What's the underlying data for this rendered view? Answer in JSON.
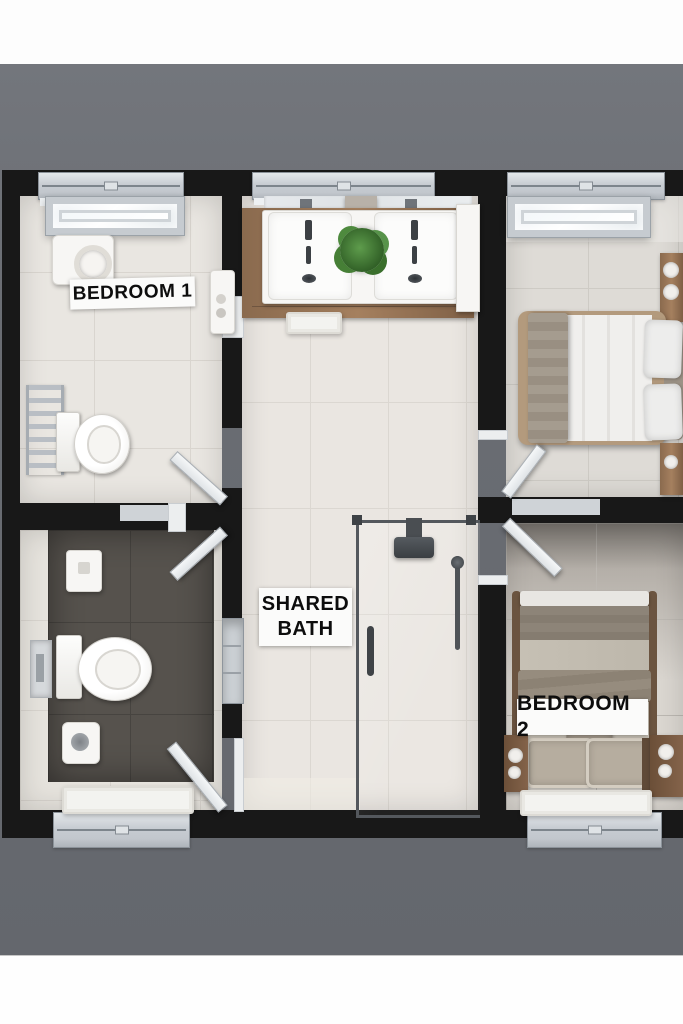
{
  "title": "3D floor plan render - two bedrooms with shared bath",
  "view": "top-down",
  "labels": {
    "bedroom1": "BEDROOM 1",
    "shared_bath": [
      "SHARED",
      "BATH"
    ],
    "bedroom2": "BEDROOM 2"
  },
  "rooms": [
    {
      "id": "bedroom-1",
      "label": "BEDROOM 1",
      "floor": "light ceramic tile",
      "fixtures": [
        "skylight-window",
        "towel-cabinet",
        "towel-radiator",
        "toilet",
        "wall-shelf",
        "swing-door"
      ]
    },
    {
      "id": "wc",
      "label": "",
      "floor": "dark slate tile with light border",
      "fixtures": [
        "cistern-box",
        "toilet",
        "hand-sprayer",
        "flush-plate",
        "bath-mat",
        "swing-door-upper",
        "swing-door-lower",
        "window"
      ]
    },
    {
      "id": "shared-bath",
      "label": "SHARED BATH",
      "floor": "light ceramic tile",
      "fixtures": [
        "mirror-strip",
        "double-vanity",
        "twin-sinks",
        "potted-plant",
        "tall-cabinet",
        "bath-mat",
        "wall-niche",
        "walk-in-shower",
        "rain-shower-head",
        "hand-shower",
        "window"
      ]
    },
    {
      "id": "bedroom-2-sleeping-nook",
      "label": "",
      "floor": "warm gray tile",
      "fixtures": [
        "skylight-window",
        "double-bed",
        "pillows",
        "nightstand",
        "nightstand",
        "swing-door",
        "window"
      ]
    },
    {
      "id": "bedroom-2",
      "label": "BEDROOM 2",
      "floor": "warm gray tile",
      "fixtures": [
        "double-bed",
        "pillows",
        "nightstand",
        "nightstand",
        "rug",
        "swing-door",
        "window"
      ]
    }
  ],
  "palette": {
    "backdrop_gray": "#6d7076",
    "band_white": "#fdfdfd",
    "wall_black": "#181818",
    "tile_light": "#e9e6e1",
    "tile_grout": "#d9d5cf",
    "tile_dark": "#56524d",
    "wood_vanity": "#a58465",
    "wood_nightstand": "#7b5c42",
    "window_frame": "#c9cdd2",
    "glass_frame": "#54585d",
    "plant_green": "#4a8a3c",
    "bedding_white": "#f0efed",
    "bedding_taupe": "#8d8478",
    "label_bg": "#fbfbfa",
    "label_text": "#0d0d0d"
  }
}
